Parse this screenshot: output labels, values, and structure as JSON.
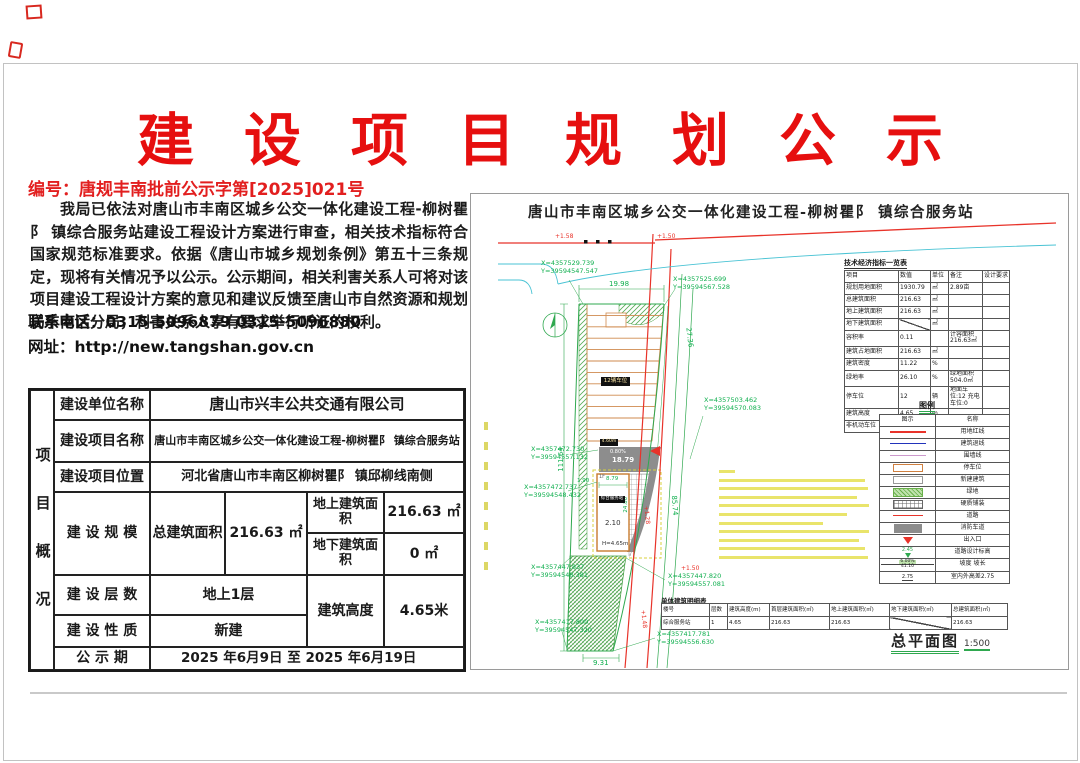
{
  "page": {
    "title": "建设项目规划公示",
    "doc_no": "编号：唐规丰南批前公示字第[2025]021号",
    "body": "我局已依法对唐山市丰南区城乡公交一体化建设工程-柳树瞿阝 镇综合服务站建设工程设计方案进行审查，相关技术指标符合国家规范标准要求。依据《唐山市城乡规划条例》第五十三条规定，现将有关情况予以公示。公示期间，相关利害关系人可将对该项目建设工程设计方案的意见和建议反馈至唐山市自然资源和规划局丰南区分局，利害关系人享有要求举行听证的权利。",
    "phone": "联系电话：0315-5096879  0315-5096880",
    "website": "网址：http://new.tangshan.gov.cn"
  },
  "project_table": {
    "side_label": "项目概况",
    "unit_label": "建设单位名称",
    "unit_value": "唐山市兴丰公共交通有限公司",
    "name_label": "建设项目名称",
    "name_value": "唐山市丰南区城乡公交一体化建设工程-柳树瞿阝 镇综合服务站",
    "loc_label": "建设项目位置",
    "loc_value": "河北省唐山市丰南区柳树瞿阝 镇邱柳线南侧",
    "scale_label": "建 设 规 模",
    "total_label": "总建筑面积",
    "total_value": "216.63 ㎡",
    "above_label": "地上建筑面积",
    "above_value": "216.63 ㎡",
    "below_label": "地下建筑面积",
    "below_value": "0 ㎡",
    "floors_label": "建 设 层 数",
    "floors_value": "地上1层",
    "height_label": "建筑高度",
    "height_value": "4.65米",
    "nature_label": "建 设 性 质",
    "nature_value": "新建",
    "period_label": "公 示 期",
    "period_value": "2025 年6月9日 至 2025 年6月19日"
  },
  "drawing": {
    "title": "唐山市丰南区城乡公交一体化建设工程-柳树瞿阝 镇综合服务站",
    "indicators": {
      "title": "技术经济指标一览表",
      "headers": [
        "项目",
        "数值",
        "单位",
        "备注",
        "设计要求"
      ],
      "rows": [
        {
          "item": "规划用地面积",
          "value": "1930.79",
          "unit": "㎡",
          "note": "2.89亩",
          "req": ""
        },
        {
          "item": "总建筑面积",
          "value": "216.63",
          "unit": "㎡",
          "note": "",
          "req": ""
        },
        {
          "item": "地上建筑面积",
          "value": "216.63",
          "unit": "㎡",
          "note": "",
          "req": ""
        },
        {
          "item": "地下建筑面积",
          "value": "",
          "unit": "㎡",
          "note": "",
          "req": ""
        },
        {
          "item": "容积率",
          "value": "0.11",
          "unit": "",
          "note": "计容面积216.63㎡",
          "req": ""
        },
        {
          "item": "建筑占地面积",
          "value": "216.63",
          "unit": "㎡",
          "note": "",
          "req": ""
        },
        {
          "item": "建筑密度",
          "value": "11.22",
          "unit": "%",
          "note": "",
          "req": ""
        },
        {
          "item": "绿地率",
          "value": "26.10",
          "unit": "%",
          "note": "绿地面积504.0㎡",
          "req": ""
        },
        {
          "item": "停车位",
          "value": "12",
          "unit": "辆",
          "note": "地面车位:12 充电车位:0",
          "req": ""
        },
        {
          "item": "建筑高度",
          "value": "4.65",
          "unit": "m",
          "note": "",
          "req": ""
        },
        {
          "item": "非机动车位",
          "value": "10",
          "unit": "辆",
          "note": "",
          "req": ""
        }
      ]
    },
    "legend": {
      "title": "图例",
      "col_symbol": "图示",
      "col_name": "名称",
      "names": [
        "用地红线",
        "建筑退线",
        "围墙线",
        "停车位",
        "新建建筑",
        "绿地",
        "硬质铺装",
        "道路",
        "消防车道",
        "出入口",
        "道路设计标高",
        "坡度 坡长",
        "室内外高差2.75"
      ],
      "elev_value": "2.45",
      "slope_top": "6.00%",
      "slope_bottom": "41.10",
      "diff_value": "2.75"
    },
    "buildings": {
      "title": "单体建筑明细表",
      "headers": [
        "楼号",
        "层数",
        "建筑高度(m)",
        "首层建筑面积(㎡)",
        "地上建筑面积(㎡)",
        "地下建筑面积(㎡)",
        "总建筑面积(㎡)"
      ],
      "row": [
        "综合服务站",
        "1",
        "4.65",
        "216.63",
        "216.63",
        "",
        "216.63"
      ]
    },
    "plan_label": "总平面图",
    "plan_scale": "1:500",
    "coords": [
      {
        "x": "X=4357529.739",
        "y": "Y=39594547.547"
      },
      {
        "x": "X=4357525.699",
        "y": "Y=39594567.528"
      },
      {
        "x": "X=4357503.462",
        "y": "Y=39594570.083"
      },
      {
        "x": "X=4357472.730",
        "y": "Y=39594557.132"
      },
      {
        "x": "X=4357472.737",
        "y": "Y=39594548.432"
      },
      {
        "x": "X=4357447.837",
        "y": "Y=39594548.381"
      },
      {
        "x": "X=4357447.820",
        "y": "Y=39594557.081"
      },
      {
        "x": "X=4357417.800",
        "y": "Y=39594547.320"
      },
      {
        "x": "X=4357417.781",
        "y": "Y=39594556.630"
      }
    ],
    "dims": {
      "top_width": "19.98",
      "east": "27.36",
      "west": "111.64",
      "road": "85.74",
      "south": "9.31",
      "bld_width": "8.79",
      "bld_depth": "24.80",
      "bld_offset": "2.10",
      "bld_height": "H=4.65m",
      "west_gap": "1.90",
      "floor": "1F",
      "ramp_len": "18.79",
      "ramp_slope": "0.80%"
    },
    "labels": {
      "parking": "12辆车位",
      "gate_width": "4.60m",
      "building_name": "综合服务站"
    },
    "road_marks": [
      "+1.58",
      "+1.50",
      "+1.28",
      "+1.48",
      "+1.50"
    ]
  }
}
